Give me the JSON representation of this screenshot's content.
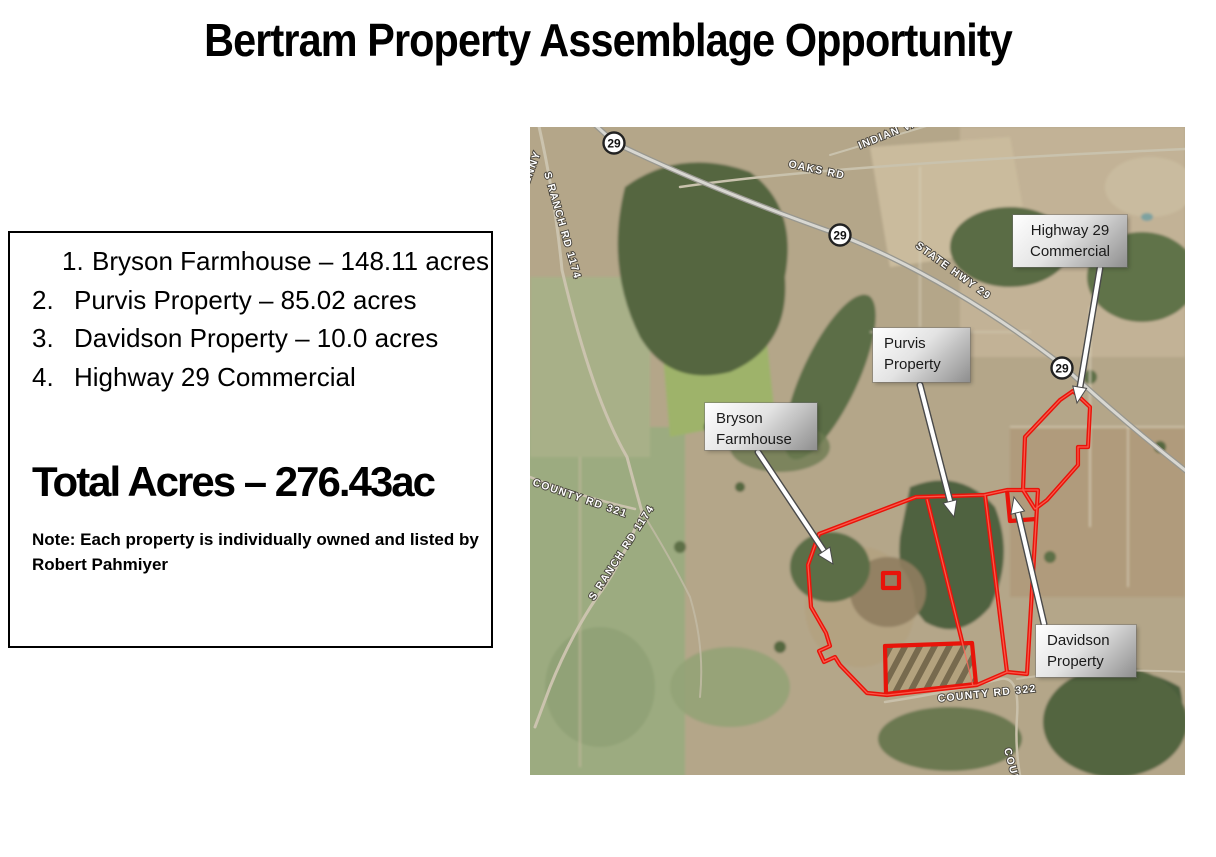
{
  "title": "Bertram Property Assemblage Opportunity",
  "info_box": {
    "items": [
      {
        "num": "1.",
        "text": "Bryson Farmhouse – 148.11 acres"
      },
      {
        "num": "2.",
        "text": "Purvis Property – 85.02 acres"
      },
      {
        "num": "3.",
        "text": "Davidson Property – 10.0 acres"
      },
      {
        "num": "4.",
        "text": "Highway 29 Commercial"
      }
    ],
    "total_line": "Total Acres – 276.43ac",
    "note": "Note: Each property is individually owned and listed by Robert Pahmiyer"
  },
  "map": {
    "property_labels": {
      "highway29": "Highway 29\nCommercial",
      "purvis": "Purvis\nProperty",
      "bryson": "Bryson\nFarmhouse",
      "davidson": "Davidson\nProperty"
    },
    "road_labels": {
      "state_hwy_29": "STATE HWY 29",
      "oaks_rd": "OAKS RD",
      "indian_rd": "INDIAN VA",
      "s_ranch_rd_1174": "S RANCH RD 1174",
      "county_rd_321": "COUNTY RD 321",
      "county_rd_bottom": "COUNTY RD 322",
      "county_rd_vertical": "COUNTY RD",
      "corner_partial": "HENNY"
    },
    "highway_shields": [
      {
        "label": "29"
      },
      {
        "label": "29"
      },
      {
        "label": "29"
      }
    ],
    "colors": {
      "parcel_outline": "#e8140a",
      "arrow_fill": "#ffffff",
      "label_text": "#1a1a1a"
    }
  }
}
